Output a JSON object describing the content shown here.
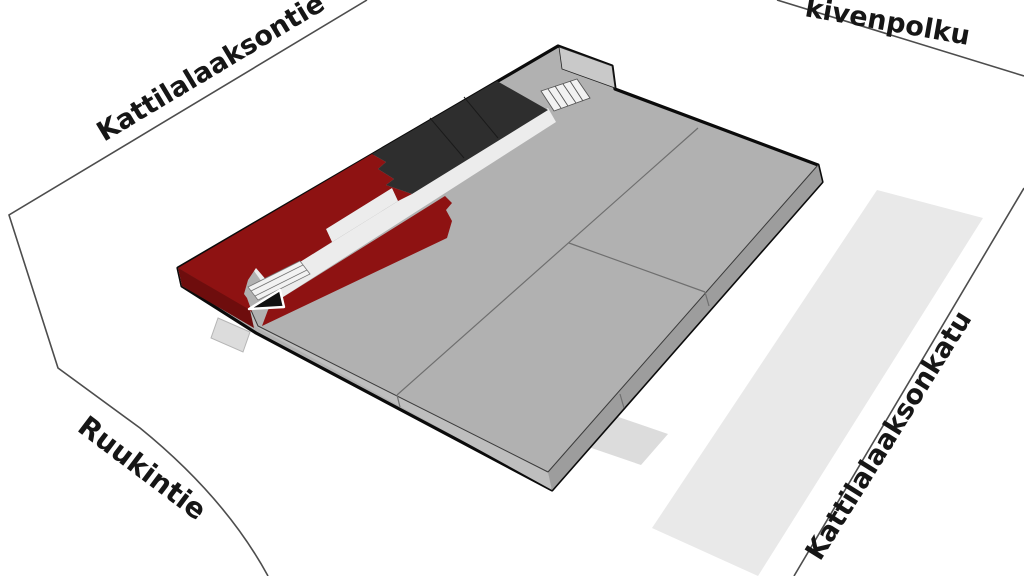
{
  "map": {
    "type": "3d-site-plan",
    "streets": [
      {
        "id": "kattilalaaksontie",
        "label": "Kattilalaaksontie"
      },
      {
        "id": "kivenpolku",
        "label": "kivenpolku"
      },
      {
        "id": "ruukintie",
        "label": "Ruukintie"
      },
      {
        "id": "kattilalaaksonkatu",
        "label": "Kattilalaaksonkatu"
      }
    ],
    "building": {
      "zones": [
        {
          "id": "main-roof",
          "color": "#B1B1B1"
        },
        {
          "id": "highlighted-unit",
          "color": "#8E1212"
        },
        {
          "id": "dark-roof-section",
          "color": "#2E2E2E"
        },
        {
          "id": "corridor",
          "color": "#ECECEC"
        },
        {
          "id": "wing",
          "color": "#B1B1B1"
        }
      ],
      "icons": [
        {
          "id": "entrance-arrow-icon"
        },
        {
          "id": "stairs-icon"
        },
        {
          "id": "entrance-ramp-icon"
        }
      ]
    },
    "colors": {
      "highlight_red": "#8E1212",
      "highlight_red_side": "#6E0D0D",
      "dark_section": "#2E2E2E",
      "dark_section_line": "#1A1A1A",
      "roof_gray": "#B1B1B1",
      "side_gray_light": "#BEBEBE",
      "side_gray_dark": "#9D9D9D",
      "wing_side_gray": "#C9C9C9",
      "corridor_white": "#ECECEC",
      "stairs_white": "#F2F2F2",
      "road_strip": "#E9E9E9",
      "tab_gray": "#DCDCDC",
      "outline": "#0B0B0B",
      "street_line": "#4D4D4D",
      "roof_seam": "#6F6F6F",
      "label_text": "#161616",
      "background": "#FFFFFF"
    }
  }
}
